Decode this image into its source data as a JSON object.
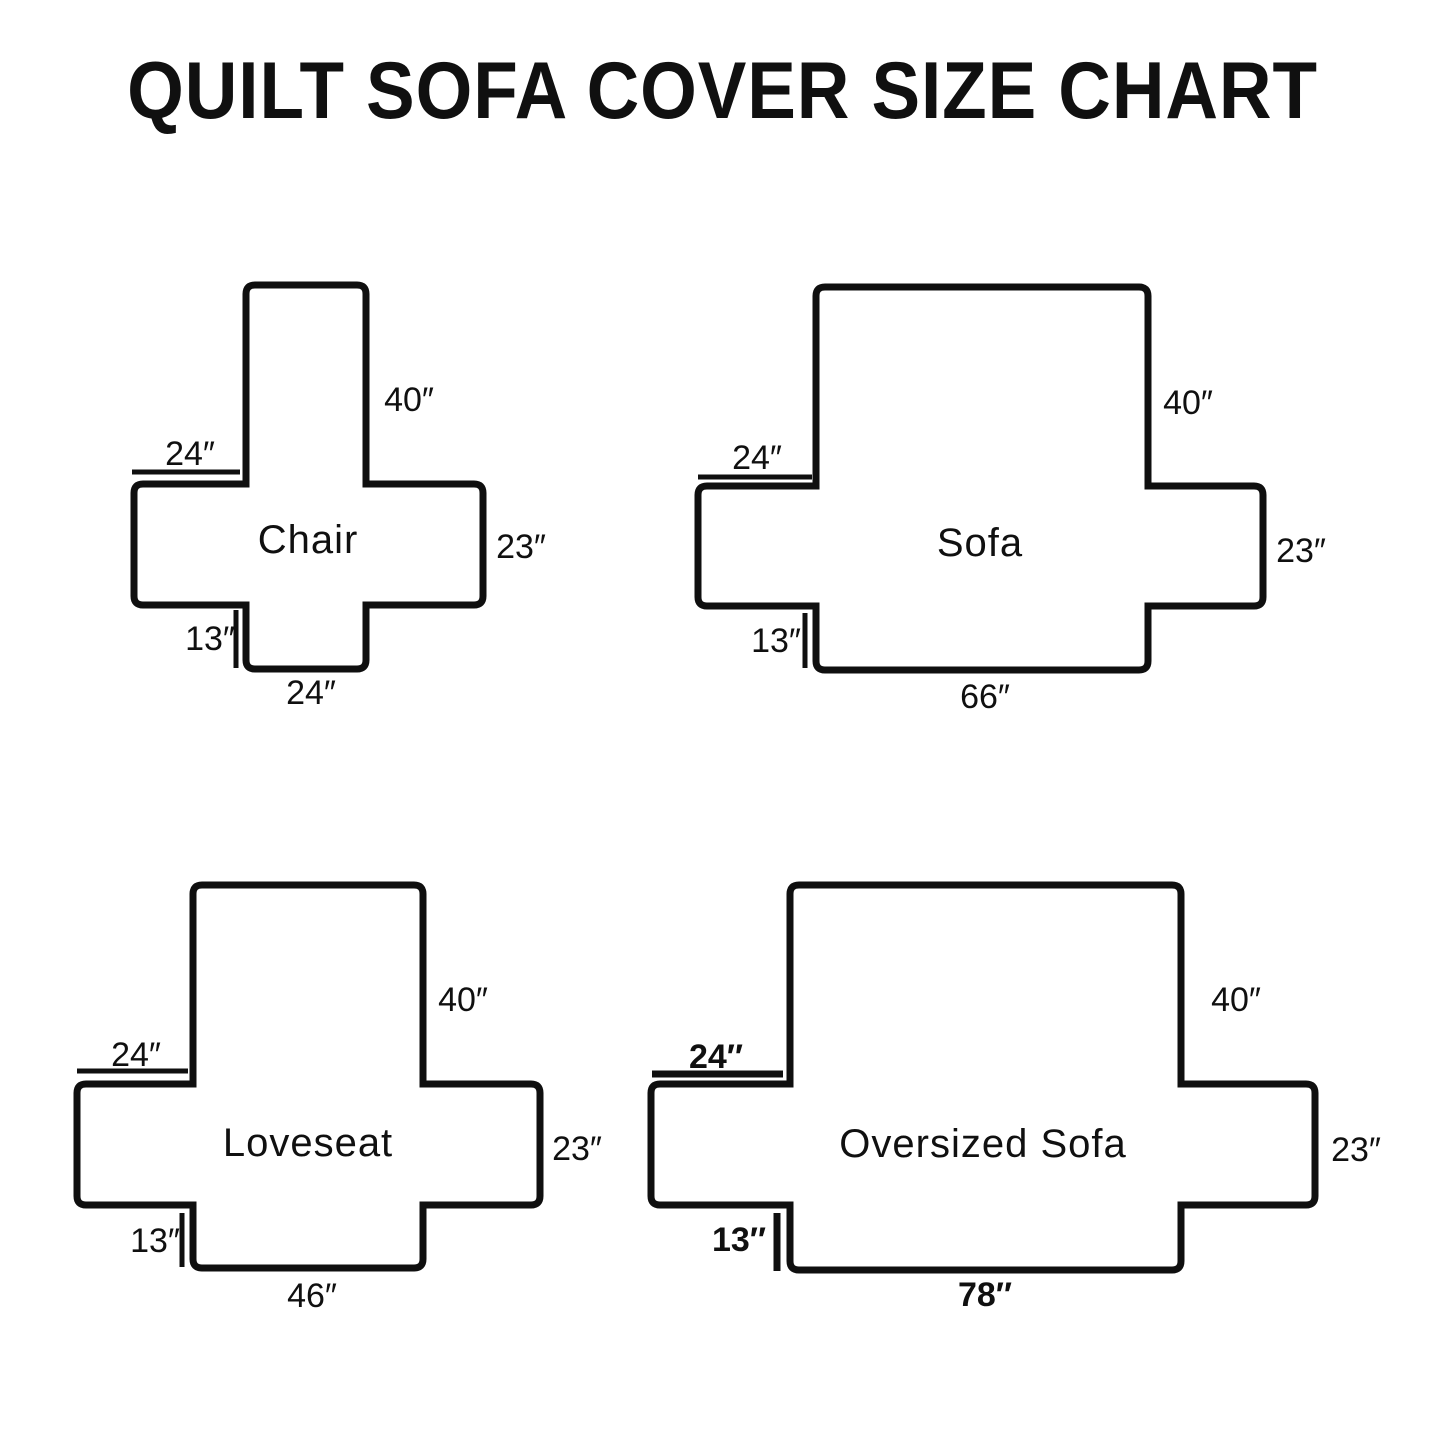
{
  "title": "QUILT SOFA COVER SIZE CHART",
  "panels": [
    {
      "name": "Chair",
      "back": "40″",
      "arm": "24″",
      "side": "23″",
      "skirt": "13″",
      "bottom": "24″"
    },
    {
      "name": "Sofa",
      "back": "40″",
      "arm": "24″",
      "side": "23″",
      "skirt": "13″",
      "bottom": "66″"
    },
    {
      "name": "Loveseat",
      "back": "40″",
      "arm": "24″",
      "side": "23″",
      "skirt": "13″",
      "bottom": "46″"
    },
    {
      "name": "Oversized Sofa",
      "back": "40″",
      "arm": "24″",
      "side": "23″",
      "skirt": "13″",
      "bottom": "78″"
    }
  ]
}
